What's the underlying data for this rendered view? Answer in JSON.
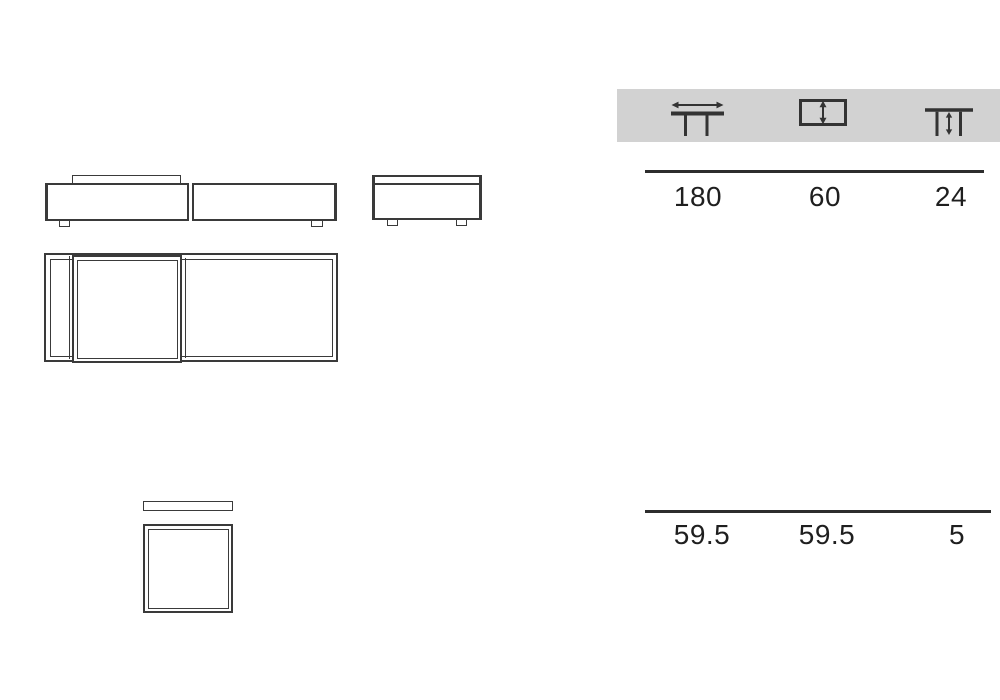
{
  "spec_table": {
    "header": {
      "background": "#d2d2d2",
      "icons": [
        {
          "name": "table-width-icon"
        },
        {
          "name": "table-depth-icon"
        },
        {
          "name": "table-height-icon"
        }
      ]
    },
    "rows": [
      [
        "180",
        "60",
        "24"
      ],
      [
        "59.5",
        "59.5",
        "5"
      ]
    ]
  },
  "colors": {
    "header_background": "#d2d2d2",
    "line_color": "#3a3a3a",
    "rule_color": "#2d2d2d",
    "text_color": "#1f1f1f",
    "page_background": "#ffffff"
  }
}
